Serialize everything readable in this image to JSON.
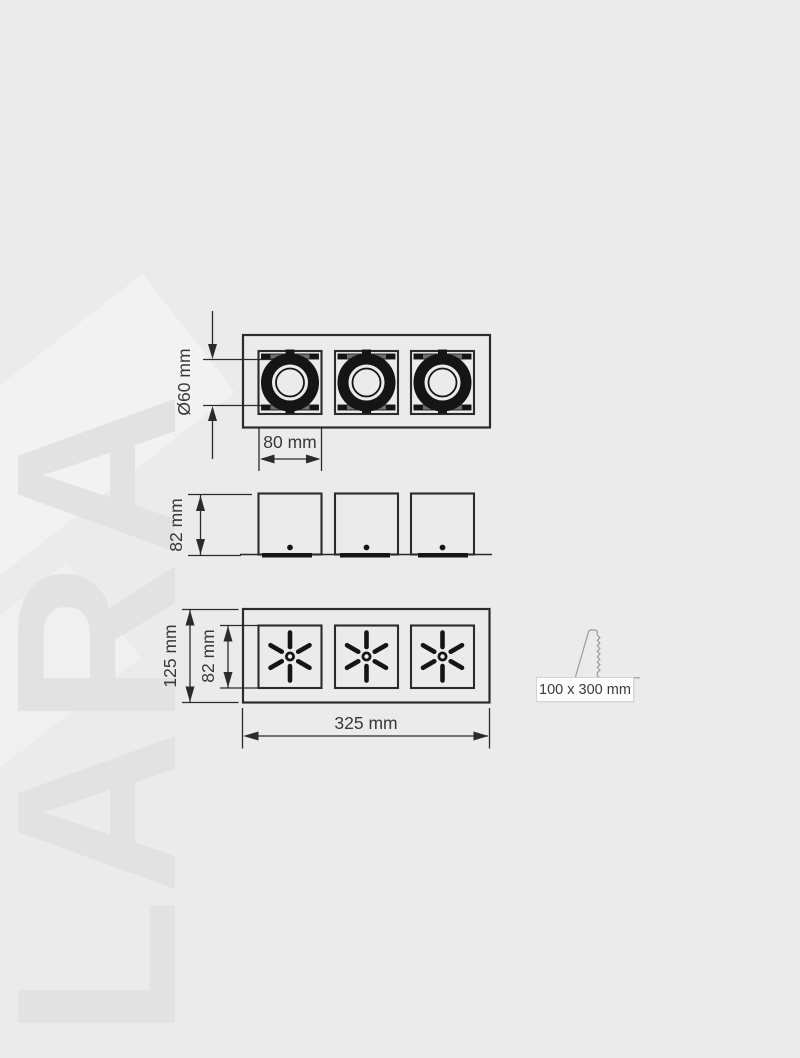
{
  "watermark_text": "LARA",
  "drawing": {
    "top_view": {
      "dim_diameter": "Ø60 mm",
      "dim_module": "80 mm"
    },
    "side_view": {
      "dim_height": "82 mm"
    },
    "front_view": {
      "dim_height_outer": "125 mm",
      "dim_height_inner": "82 mm",
      "dim_width": "325 mm"
    },
    "cutout": {
      "label": "100 x 300 mm"
    }
  },
  "colors": {
    "background": "#ebebeb",
    "watermark": "#e2e2e2",
    "line": "#2b2b2b",
    "fill_dark": "#151515",
    "text": "#383838",
    "cutout_line": "#9b9b9b",
    "badge_background": "#fdfdfd",
    "badge_border": "#d4d4d4"
  }
}
